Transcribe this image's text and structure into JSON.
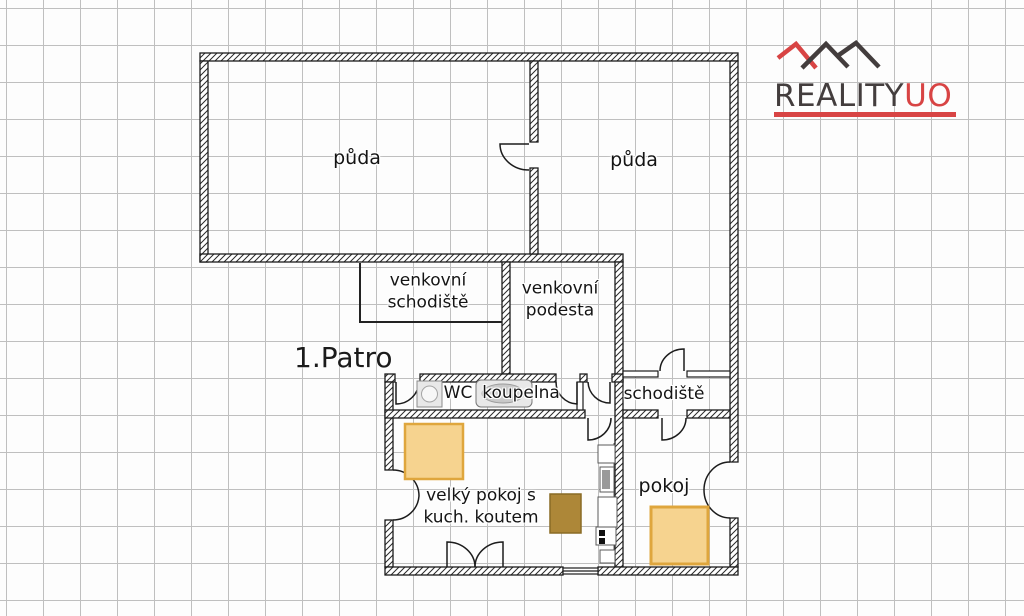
{
  "floor": {
    "title": "1.Patro"
  },
  "logo": {
    "brand": "REALITY",
    "suffix": "UO"
  },
  "rooms": {
    "attic_left": {
      "label": "půda"
    },
    "attic_right": {
      "label": "půda"
    },
    "outdoor_staircase": {
      "label": "venkovní\nschodiště"
    },
    "outdoor_landing": {
      "label": "venkovní\npodesta"
    },
    "wc": {
      "label": "WC"
    },
    "bathroom": {
      "label": "koupelna"
    },
    "staircase": {
      "label": "schodiště"
    },
    "living_room": {
      "label": "velký pokoj s\nkuch. koutem"
    },
    "bedroom": {
      "label": "pokoj"
    }
  },
  "fixtures": [
    "washing-machine",
    "bathtub",
    "bed",
    "bed",
    "table",
    "kitchen-counter",
    "stove"
  ],
  "colors": {
    "brand_red": "#d84444",
    "brand_dark": "#433d3d",
    "wall_line": "#1c1c1c",
    "grid_line": "#bfbfbf",
    "bed_fill": "#f6d38f",
    "bed_border": "#dfa63d",
    "table_fill": "#ad8738",
    "table_border": "#8a6b25",
    "fixture_fill": "#e8e8e8",
    "fixture_line": "#777777"
  }
}
